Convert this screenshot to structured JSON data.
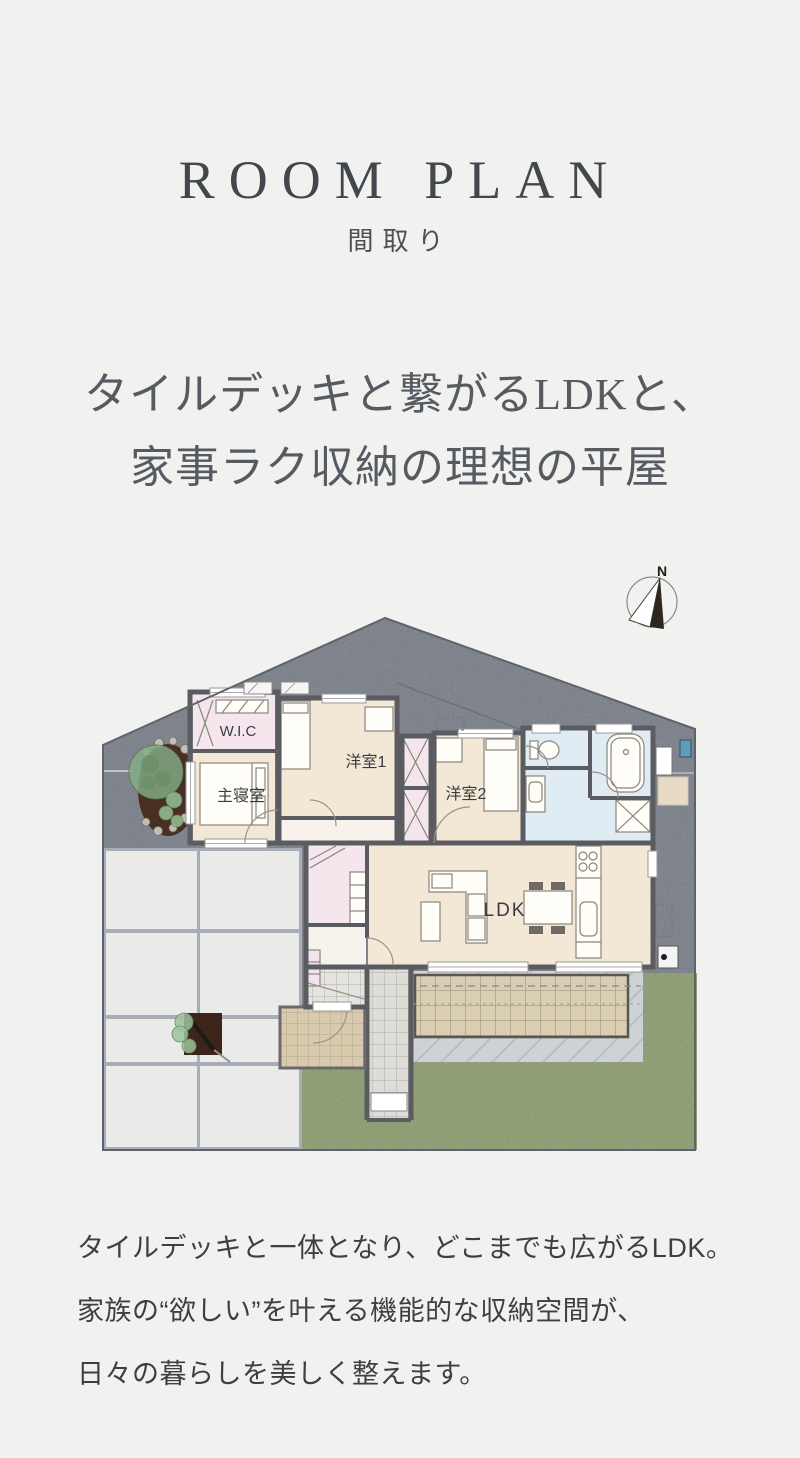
{
  "page": {
    "background": "#f1f1f0"
  },
  "header": {
    "title": "ROOM PLAN",
    "subtitle": "間取り"
  },
  "headline": {
    "line1": "タイルデッキと繋がるLDKと、",
    "line2": "家事ラク収納の理想の平屋"
  },
  "floor_plan": {
    "compass_label": "N",
    "labels": {
      "wic": "W.I.C",
      "master_bedroom": "主寝室",
      "bedroom1": "洋室1",
      "bedroom2": "洋室2",
      "ldk": "LDK"
    },
    "colors": {
      "gravel": "#8e96a6",
      "grass": "#a5ba80",
      "paving": "#eaeae8",
      "paving_joint": "#a7aeb9",
      "deck": "#d9cdb2",
      "apron": "#ced2d6",
      "room_beige": "#f3e8d6",
      "room_pink": "#f5e6ee",
      "room_blue": "#dfecf4",
      "corridor": "#f8f1ec",
      "porch": "#d7caad",
      "walkway": "#dedcd7",
      "genkan": "#e6e4e0",
      "wall": "#5b5c61"
    }
  },
  "description": {
    "line1": "タイルデッキと一体となり、どこまでも広がるLDK。",
    "line2": "家族の“欲しい”を叶える機能的な収納空間が、",
    "line3": "日々の暮らしを美しく整えます。"
  }
}
